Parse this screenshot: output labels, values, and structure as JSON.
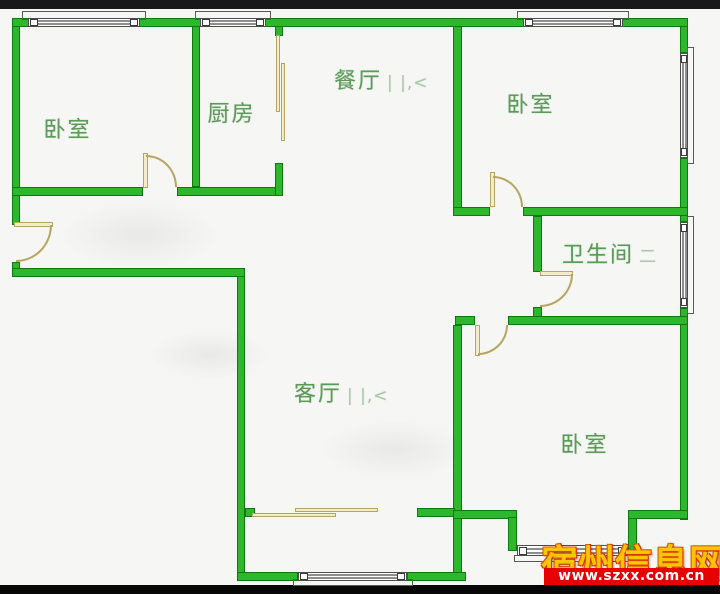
{
  "rooms": [
    {
      "id": "bedroom-top-left",
      "label": "卧室",
      "artifact": ""
    },
    {
      "id": "kitchen",
      "label": "厨房",
      "artifact": ""
    },
    {
      "id": "dining-room",
      "label": "餐厅",
      "artifact": "| |,<"
    },
    {
      "id": "bedroom-top-right",
      "label": "卧室",
      "artifact": ""
    },
    {
      "id": "bathroom",
      "label": "卫生间",
      "artifact": "二"
    },
    {
      "id": "living-room",
      "label": "客厅",
      "artifact": "| |,<"
    },
    {
      "id": "bedroom-bottom-right",
      "label": "卧室",
      "artifact": ""
    }
  ],
  "watermark": {
    "site_name": "宿州信息网",
    "url": "www.szxx.com.cn"
  },
  "colors": {
    "bg": "#f6f6f4",
    "wall_fill": "#2db72d",
    "wall_edge": "#0d7a0f",
    "door_fill": "#f2ecca",
    "door_edge": "#b5a55e",
    "label_green": "#5b9b58",
    "wm_yellow": "#ffc400",
    "wm_red": "#e60000",
    "letterbox_top": "#18181b",
    "letterbox_bottom": "#070707"
  }
}
